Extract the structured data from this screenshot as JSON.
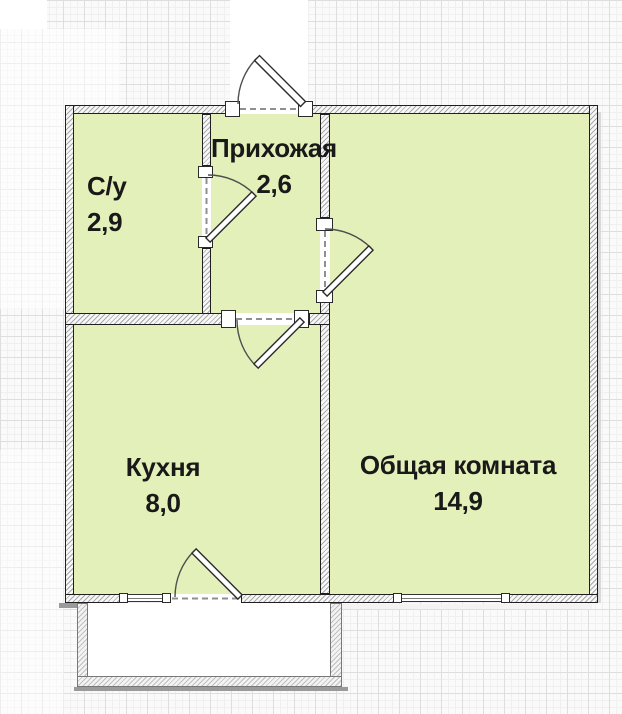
{
  "rooms": [
    {
      "name": "С/у",
      "area": "2,9"
    },
    {
      "name": "Прихожая",
      "area": "2,6"
    },
    {
      "name": "Кухня",
      "area": "8,0"
    },
    {
      "name": "Общая комната",
      "area": "14,9"
    }
  ],
  "colors": {
    "room_fill": "#e4f0ba",
    "wall_outline": "#1f1f1f",
    "wall_hatch": "#a9a9a9",
    "balcony_wall": "#bfbfbf",
    "grid_major": "#dedede",
    "grid_minor": "#f0f0f0",
    "door_arc": "#4f4f4f",
    "label_text": "#191919"
  }
}
